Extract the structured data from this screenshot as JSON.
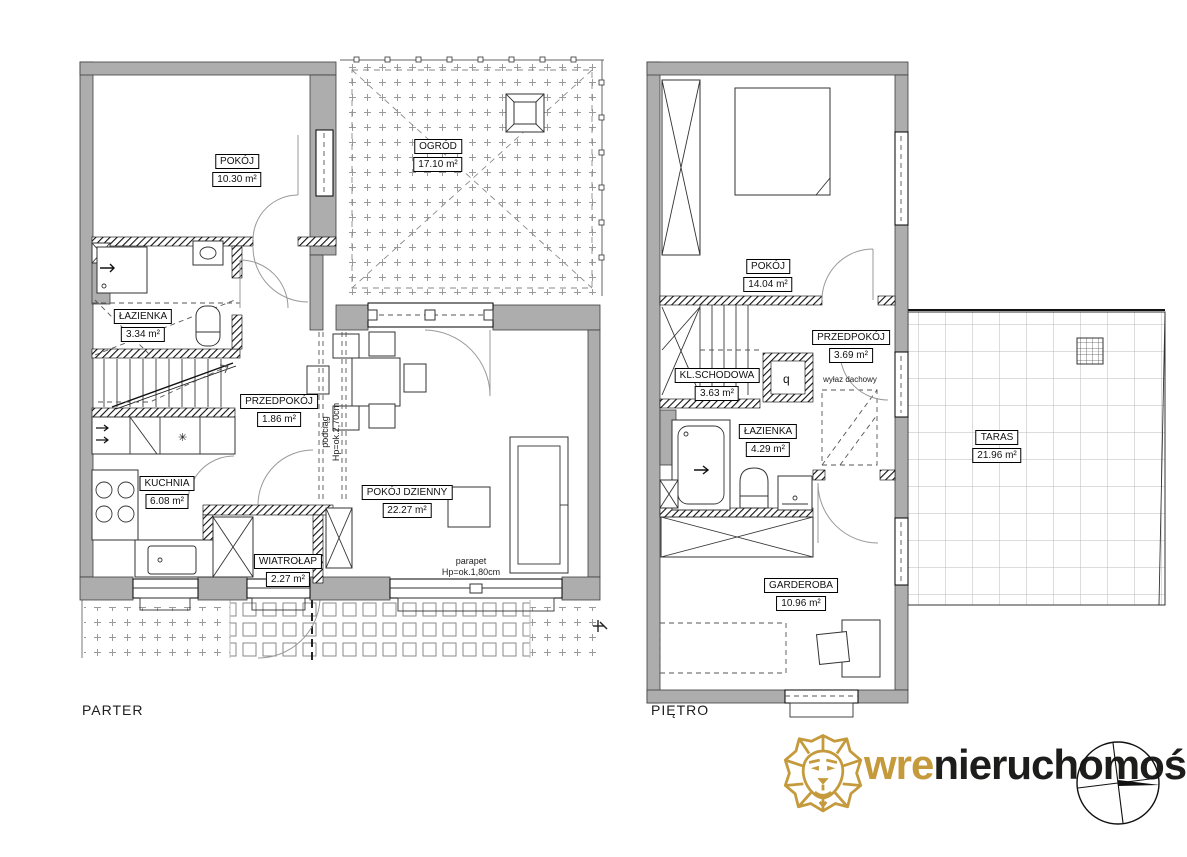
{
  "page": {
    "background": "#ffffff"
  },
  "floors": [
    {
      "title": "PARTER",
      "rooms": [
        {
          "name": "POKÓJ",
          "area": "10.30 m²"
        },
        {
          "name": "OGRÓD",
          "area": "17.10 m²"
        },
        {
          "name": "ŁAZIENKA",
          "area": "3.34 m²"
        },
        {
          "name": "PRZEDPOKÓJ",
          "area": "1.86 m²"
        },
        {
          "name": "KUCHNIA",
          "area": "6.08 m²"
        },
        {
          "name": "WIATROŁAP",
          "area": "2.27 m²"
        },
        {
          "name": "POKÓJ DZIENNY",
          "area": "22.27 m²"
        }
      ],
      "annotations": {
        "beam_label": "podciąg",
        "beam_height": "Hp=ok.2,70cm",
        "sill_label": "parapet",
        "sill_height": "Hp=ok.1,80cm"
      },
      "symbols": {
        "fridge": "✳",
        "dishwasher": "Z"
      }
    },
    {
      "title": "PIĘTRO",
      "rooms": [
        {
          "name": "POKÓJ",
          "area": "14.04 m²"
        },
        {
          "name": "KL.SCHODOWA",
          "area": "3.63 m²"
        },
        {
          "name": "PRZEDPOKÓJ",
          "area": "3.69 m²"
        },
        {
          "name": "ŁAZIENKA",
          "area": "4.29 m²"
        },
        {
          "name": "GARDEROBA",
          "area": "10.96 m²"
        },
        {
          "name": "TARAS",
          "area": "21.96 m²"
        }
      ],
      "annotations": {
        "roof_hatch": "wyłaz dachowy"
      },
      "symbols": {
        "boiler": "q"
      }
    }
  ],
  "logo": {
    "brand_primary": "wre",
    "brand_secondary": "nieruchomości"
  },
  "colors": {
    "wall": "#adadad",
    "gold": "#C49A3C",
    "ink": "#1d1d1b"
  }
}
